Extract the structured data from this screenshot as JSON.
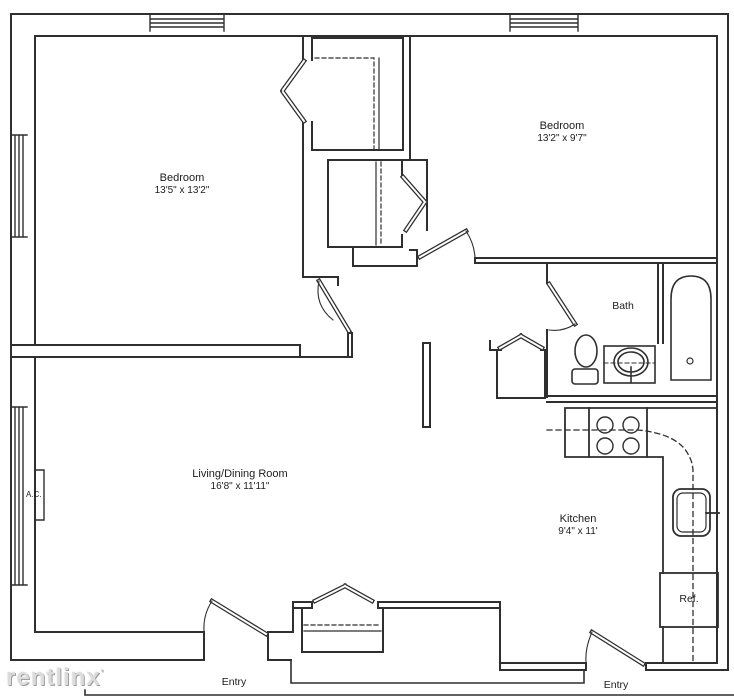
{
  "page": {
    "background": "#ffffff",
    "line_color": "#2f2f2f",
    "watermark_color": "#dcdcdc"
  },
  "floor_plan": {
    "rooms": [
      {
        "id": "bedroom-1",
        "name": "Bedroom",
        "dimensions": "13'5\" x 13'2\""
      },
      {
        "id": "bedroom-2",
        "name": "Bedroom",
        "dimensions": "13'2\" x 9'7\""
      },
      {
        "id": "living-dining",
        "name": "Living/Dining Room",
        "dimensions": "16'8\" x 11'11\""
      },
      {
        "id": "kitchen",
        "name": "Kitchen",
        "dimensions": "9'4\" x 11'"
      },
      {
        "id": "bath",
        "name": "Bath"
      }
    ],
    "labels": {
      "bath": "Bath",
      "ac_unit": "A.C.",
      "refrigerator": "Ref.",
      "entry_left": "Entry",
      "entry_right": "Entry"
    },
    "fixtures": [
      "toilet",
      "vanity-sink",
      "bathtub",
      "stove",
      "kitchen-sink",
      "refrigerator",
      "ac-unit"
    ],
    "watermark": "rentlinx",
    "watermark_mark": "'"
  }
}
